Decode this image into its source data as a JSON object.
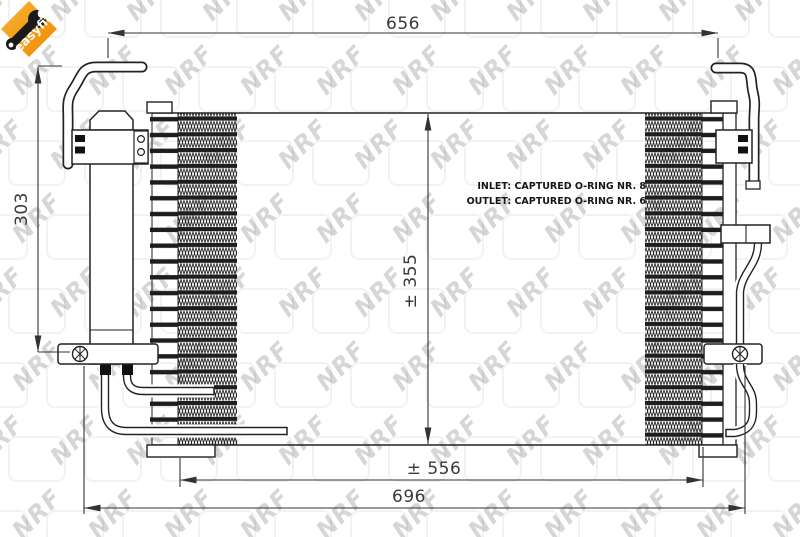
{
  "page": {
    "background": "#ffffff"
  },
  "logo": {
    "text": "easyfit",
    "orange_light": "#F9B233",
    "orange_dark": "#EE8A00"
  },
  "watermark": {
    "text": "NRF"
  },
  "drawing": {
    "line_color": "#222222",
    "dim_color": "#3a3a3a",
    "dimensions": {
      "top_width": "656",
      "left_height": "303",
      "core_height": "± 355",
      "bottom_inner_width": "± 556",
      "bottom_outer_width": "696"
    },
    "notes": {
      "inlet": "INLET: CAPTURED O-RING NR. 8",
      "outlet": "OUTLET: CAPTURED O-RING NR. 6"
    }
  }
}
